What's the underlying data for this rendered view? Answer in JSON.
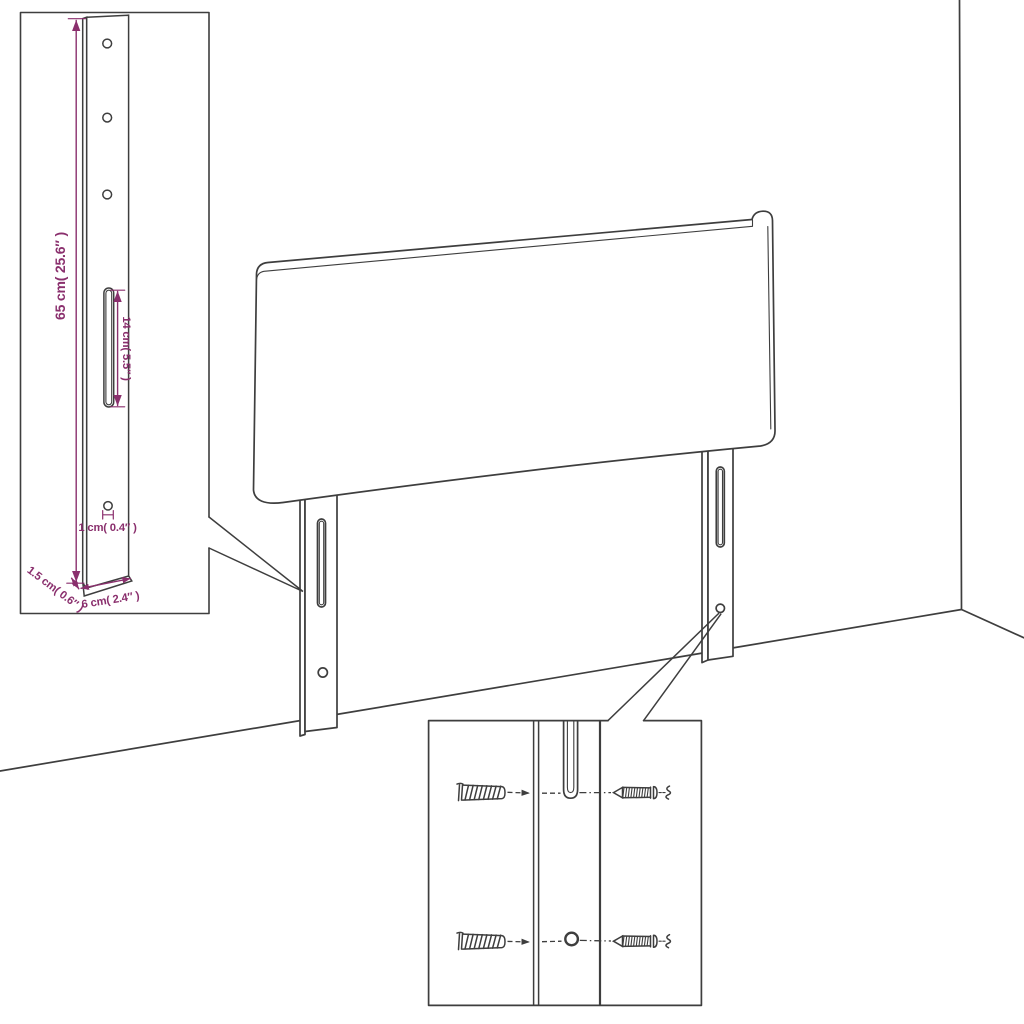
{
  "colors": {
    "dimension": "#8a2f6d",
    "line": "#3e3e3e",
    "background": "#ffffff"
  },
  "dimensions": {
    "leg_height": "65 cm( 25.6″ )",
    "slot_length": "14 cm( 5.5″ )",
    "hole_diameter": "1 cm( 0.4″ )",
    "leg_thickness": "1.5 cm( 0.6″ )",
    "leg_width": "6 cm( 2.4″ )"
  },
  "icons": {
    "wall_plug": "wall-plug-icon",
    "screw": "screw-icon"
  }
}
